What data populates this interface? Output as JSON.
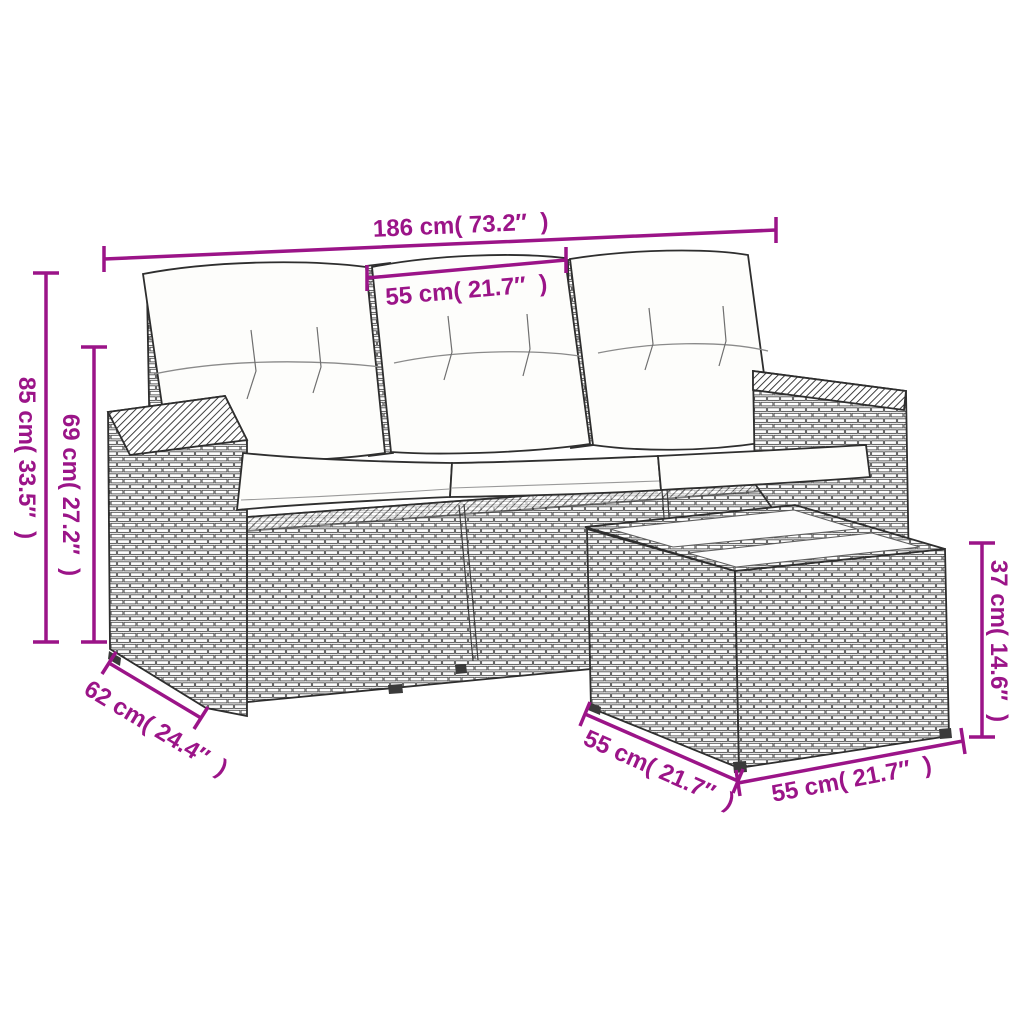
{
  "diagram": {
    "background": "#ffffff",
    "accent_color": "#9b1488",
    "line_art_color": "#2e2e2e",
    "subject": "rattan garden sofa set with cushions and glass-top side table",
    "dims": {
      "sofa_width": {
        "label": "186 cm( 73.2″  )",
        "cm": "186",
        "inch": "73.2"
      },
      "cushion_width": {
        "label": "55 cm( 21.7″  )",
        "cm": "55",
        "inch": "21.7"
      },
      "sofa_height": {
        "label": "85 cm( 33.5″  )",
        "cm": "85",
        "inch": "33.5"
      },
      "arm_height": {
        "label": "69 cm( 27.2″  )",
        "cm": "69",
        "inch": "27.2"
      },
      "sofa_depth": {
        "label": "62 cm( 24.4″  )",
        "cm": "62",
        "inch": "24.4"
      },
      "table_depth": {
        "label": "55 cm( 21.7″  )",
        "cm": "55",
        "inch": "21.7"
      },
      "table_width": {
        "label": "55 cm( 21.7″  )",
        "cm": "55",
        "inch": "21.7"
      },
      "table_height": {
        "label": "37 cm( 14.6″  )",
        "cm": "37",
        "inch": "14.6"
      }
    }
  }
}
